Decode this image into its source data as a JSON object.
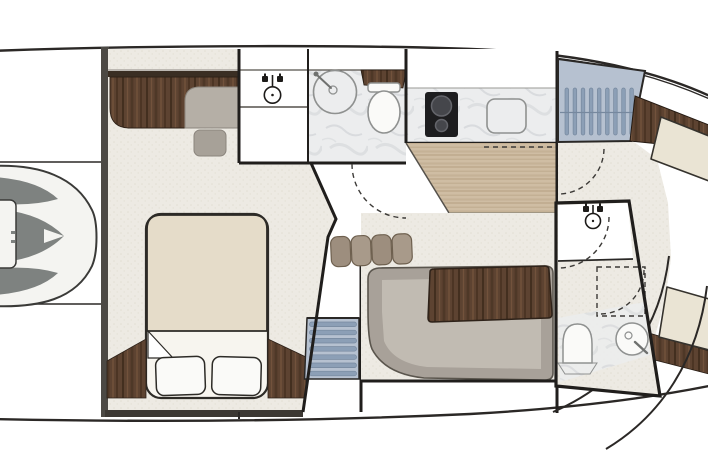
{
  "diagram": {
    "type": "yacht-floorplan",
    "view": "overhead-lower-deck",
    "companionway_step_count": 9,
    "cabin_stair_tread_count": 7,
    "salon_cushion_count": 4,
    "pillow_count": 2,
    "burner_count": 2,
    "door_swing_count": 4,
    "areas": [
      {
        "name": "bow-sunpad",
        "fixtures": [
          "sunpad-cushions",
          "bow-hatch"
        ]
      },
      {
        "name": "forward-cabin",
        "fixtures": [
          "vanity-desk",
          "desk-seat",
          "stool",
          "double-bed",
          "pillows",
          "wood-trim-wedges"
        ]
      },
      {
        "name": "forward-head",
        "fixtures": [
          "sink-faucet",
          "round-shower",
          "toilet",
          "walnut-shelf"
        ]
      },
      {
        "name": "galley",
        "fixtures": [
          "two-burner-cooktop",
          "galley-sink",
          "marble-counter",
          "oak-sole"
        ]
      },
      {
        "name": "companionway-steps",
        "fixtures": [
          "step-treads"
        ]
      },
      {
        "name": "salon",
        "fixtures": [
          "l-shaped-sofa",
          "walnut-table",
          "seat-cushions"
        ]
      },
      {
        "name": "cabin-stairs",
        "fixtures": [
          "stair-treads"
        ]
      },
      {
        "name": "aft-head",
        "fixtures": [
          "sink-faucet",
          "toilet",
          "round-shower",
          "dashed-shower-pan"
        ]
      },
      {
        "name": "aft-deck",
        "fixtures": [
          "walnut-trim-bands",
          "cream-panels",
          "stern-curves"
        ]
      }
    ]
  },
  "colors": {
    "white": "#ffffff",
    "hull_line": "#2b2826",
    "wall": "#201e1c",
    "bulkhead": "#4c4944",
    "floor_base": "#edeae3",
    "floor_dot": "#e2ded3",
    "walnut": "#5d4331",
    "walnut_dark": "#432f1f",
    "walnut_light": "#77563e",
    "trim_dark": "#3a2e23",
    "oak": "#cfbda3",
    "oak_dark": "#bca88a",
    "oak_line": "#b19a7c",
    "marble_base": "#ecedee",
    "marble_vein": "#c5cacd",
    "sofa_outer": "#a8a199",
    "sofa_seat": "#c1bbb2",
    "sofa_line": "#5a554d",
    "cushion": "#9d8e7e",
    "cushion_alt": "#a89a8a",
    "cushion_dark": "#6e604f",
    "duvet": "#e5dcc9",
    "sheet": "#f7f5ef",
    "bed_line": "#2d2b27",
    "steps_bg": "#b6c1d0",
    "step_bar": "#8c9fb6",
    "step_line": "#76889e",
    "pod_gray": "#7e8280",
    "pod_line": "#3a3a38",
    "pod_white": "#f4f4f1",
    "seat_gray": "#b5afa6",
    "stool_gray": "#a7a198",
    "cooktop": "#1d1d1f",
    "burner": "#45464b",
    "burner_rim": "#64656b",
    "cream_panel": "#eae4d4",
    "panel_line": "#35322d",
    "fixture_fill": "#fafaf8",
    "fixture_stroke": "#8f9190",
    "dash": "#3c3a37",
    "icon_dark": "#1d1b19"
  }
}
